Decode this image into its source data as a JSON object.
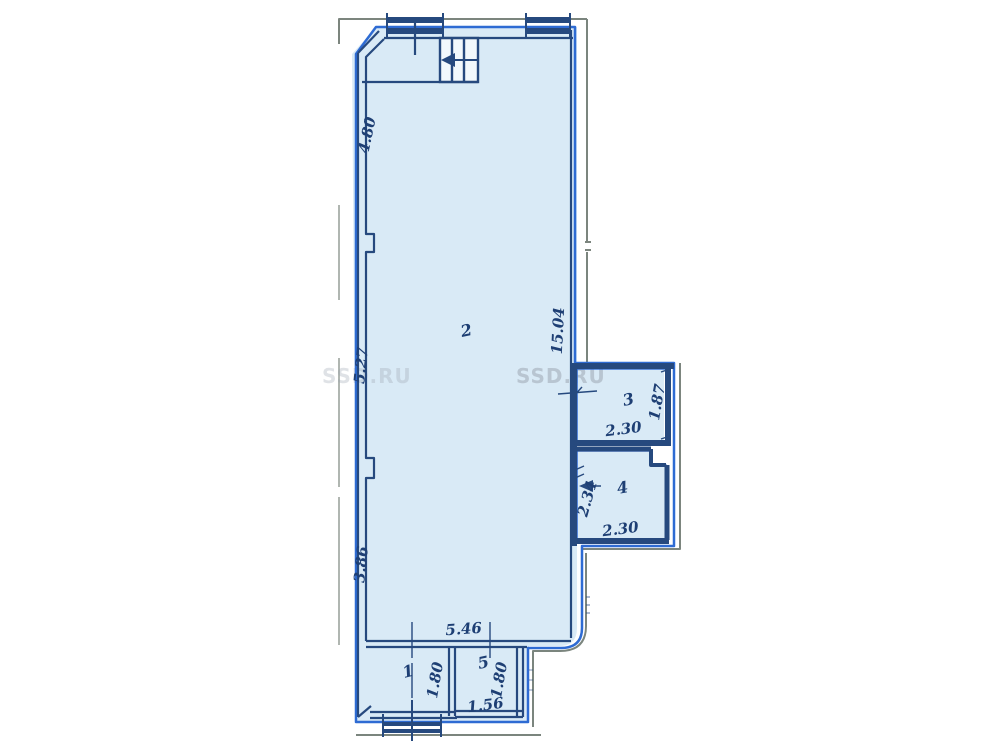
{
  "watermark": {
    "text": "SSD.RU",
    "text_partial": "SSD.RU"
  },
  "rooms": [
    {
      "label": "1"
    },
    {
      "label": "2"
    },
    {
      "label": "3"
    },
    {
      "label": "4"
    },
    {
      "label": "5"
    }
  ],
  "dimensions": {
    "left_upper": "4.80",
    "left_middle": "5.27",
    "left_lower": "3.86",
    "right_main": "15.04",
    "room3_width": "2.30",
    "room3_depth": "1.87",
    "room4_depth": "2.34",
    "room4_width": "2.30",
    "bottom_span": "5.46",
    "room1_depth": "1.80",
    "room5_depth": "1.80",
    "room5_width": "1.56"
  },
  "colors": {
    "background": "#ffffff",
    "floor_fill": "#d9eaf6",
    "stair_fill": "#f2f8fc",
    "wall_ink": "#26497e",
    "boundary_highlight": "#2e6bd3",
    "outer_faded_line": "#5b675e",
    "dimension_text": "#1e3f74",
    "watermark": "#98a1ad"
  }
}
